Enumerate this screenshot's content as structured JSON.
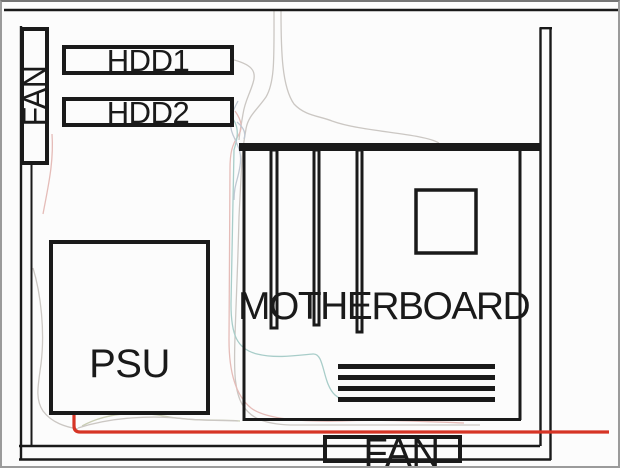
{
  "diagram": {
    "title": "PC case interior layout diagram",
    "labels": {
      "fan_left": "FAN",
      "hdd1": "HDD1",
      "hdd2": "HDD2",
      "psu": "PSU",
      "motherboard": "MOTHERBOARD",
      "fan_bottom": "FAN"
    }
  },
  "colors": {
    "outline": "#1a1a1a",
    "red_cable": "#d63425",
    "cable_gray": "#cbc7c3",
    "cable_pink": "#e5bcb8",
    "cable_teal": "#a8cdc9",
    "cable_bluegray": "#bfc8d2",
    "cable_green": "#c9cdb4",
    "paper": "#fcfcfc"
  }
}
